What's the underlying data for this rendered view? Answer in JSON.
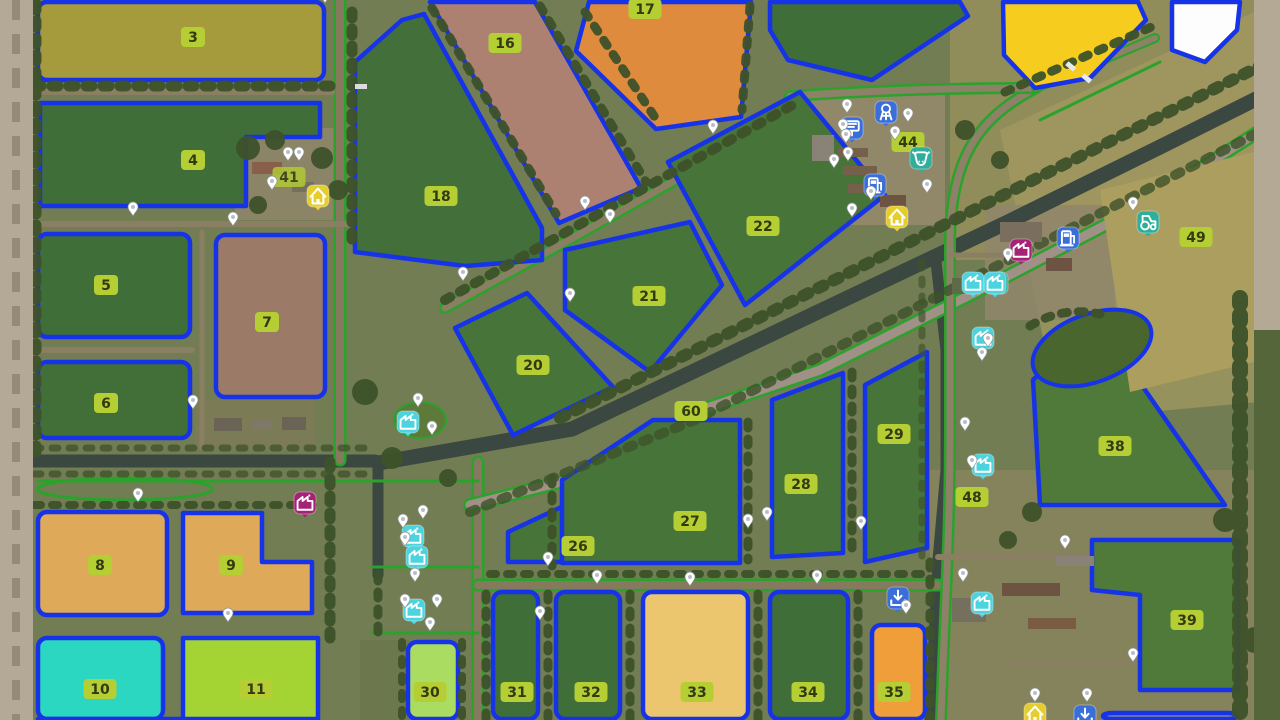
{
  "map": {
    "description": "Top-down farm map overview with numbered fields",
    "field_border_color": "#1733e8",
    "label_bg": "#b5ce33",
    "label_text_color": "#333a12",
    "road_line_color": "#2aa22c",
    "water_color": "#3a4841",
    "fields": [
      {
        "number": "3",
        "color": "#a59a3c",
        "shape": [
          [
            38,
            2
          ],
          [
            324,
            2
          ],
          [
            324,
            80
          ],
          [
            38,
            80
          ]
        ],
        "label": [
          193,
          37
        ]
      },
      {
        "number": "4",
        "color": "#3f6e39",
        "shape": [
          [
            40,
            103
          ],
          [
            320,
            103
          ],
          [
            320,
            137
          ],
          [
            246,
            137
          ],
          [
            246,
            206
          ],
          [
            40,
            206
          ]
        ],
        "label": [
          193,
          160
        ]
      },
      {
        "number": "5",
        "color": "#3f6e39",
        "shape": [
          [
            38,
            234
          ],
          [
            190,
            234
          ],
          [
            190,
            337
          ],
          [
            38,
            337
          ]
        ],
        "label": [
          106,
          285
        ]
      },
      {
        "number": "6",
        "color": "#426f37",
        "shape": [
          [
            38,
            362
          ],
          [
            190,
            362
          ],
          [
            190,
            438
          ],
          [
            38,
            438
          ]
        ],
        "label": [
          106,
          403
        ]
      },
      {
        "number": "7",
        "color": "#9b7a67",
        "shape": [
          [
            216,
            235
          ],
          [
            325,
            235
          ],
          [
            325,
            397
          ],
          [
            216,
            397
          ]
        ],
        "label": [
          267,
          322
        ]
      },
      {
        "number": "8",
        "color": "#dfa95a",
        "shape": [
          [
            38,
            512
          ],
          [
            167,
            512
          ],
          [
            167,
            615
          ],
          [
            38,
            615
          ]
        ],
        "label": [
          100,
          565
        ]
      },
      {
        "number": "9",
        "color": "#dfa95a",
        "shape": [
          [
            183,
            513
          ],
          [
            262,
            513
          ],
          [
            262,
            562
          ],
          [
            312,
            562
          ],
          [
            312,
            613
          ],
          [
            183,
            613
          ]
        ],
        "label": [
          231,
          565
        ]
      },
      {
        "number": "10",
        "color": "#2bd7c0",
        "shape": [
          [
            38,
            638
          ],
          [
            163,
            638
          ],
          [
            163,
            719
          ],
          [
            38,
            719
          ]
        ],
        "label": [
          100,
          689
        ]
      },
      {
        "number": "11",
        "color": "#a4d334",
        "shape": [
          [
            183,
            638
          ],
          [
            318,
            638
          ],
          [
            318,
            719
          ],
          [
            38,
            719
          ],
          [
            183,
            719
          ]
        ],
        "label": [
          256,
          689
        ]
      },
      {
        "number": "16",
        "color": "#ac8172",
        "shape": [
          [
            430,
            2
          ],
          [
            535,
            2
          ],
          [
            641,
            188
          ],
          [
            559,
            223
          ]
        ],
        "label": [
          505,
          43
        ]
      },
      {
        "number": "17",
        "color": "#df8b3e",
        "shape": [
          [
            589,
            2
          ],
          [
            751,
            2
          ],
          [
            741,
            117
          ],
          [
            656,
            129
          ],
          [
            576,
            51
          ]
        ],
        "label": [
          645,
          9
        ]
      },
      {
        "number": "18",
        "color": "#43703a",
        "shape": [
          [
            355,
            62
          ],
          [
            402,
            20
          ],
          [
            424,
            14
          ],
          [
            542,
            228
          ],
          [
            542,
            260
          ],
          [
            465,
            266
          ],
          [
            355,
            252
          ]
        ],
        "label": [
          441,
          196
        ]
      },
      {
        "number": "20",
        "color": "#477539",
        "shape": [
          [
            455,
            328
          ],
          [
            527,
            293
          ],
          [
            613,
            387
          ],
          [
            513,
            435
          ]
        ],
        "label": [
          533,
          365
        ]
      },
      {
        "number": "21",
        "color": "#477539",
        "shape": [
          [
            565,
            250
          ],
          [
            690,
            222
          ],
          [
            722,
            285
          ],
          [
            650,
            372
          ],
          [
            565,
            310
          ]
        ],
        "label": [
          649,
          296
        ]
      },
      {
        "number": "22",
        "color": "#477539",
        "shape": [
          [
            668,
            162
          ],
          [
            800,
            92
          ],
          [
            885,
            195
          ],
          [
            745,
            305
          ]
        ],
        "label": [
          763,
          226
        ]
      },
      {
        "number": "26",
        "color": "#477539",
        "shape": [
          [
            508,
            532
          ],
          [
            570,
            503
          ],
          [
            623,
            496
          ],
          [
            623,
            562
          ],
          [
            508,
            562
          ]
        ],
        "label": [
          578,
          546
        ]
      },
      {
        "number": "27",
        "color": "#477539",
        "shape": [
          [
            653,
            420
          ],
          [
            740,
            420
          ],
          [
            740,
            563
          ],
          [
            562,
            563
          ],
          [
            562,
            480
          ]
        ],
        "label": [
          690,
          521
        ]
      },
      {
        "number": "28",
        "color": "#477539",
        "shape": [
          [
            772,
            400
          ],
          [
            843,
            373
          ],
          [
            843,
            553
          ],
          [
            772,
            557
          ]
        ],
        "label": [
          801,
          484
        ]
      },
      {
        "number": "29",
        "color": "#477539",
        "shape": [
          [
            865,
            385
          ],
          [
            927,
            352
          ],
          [
            927,
            548
          ],
          [
            865,
            562
          ]
        ],
        "label": [
          894,
          434
        ]
      },
      {
        "number": "30",
        "color": "#abdc62",
        "shape": [
          [
            408,
            642
          ],
          [
            458,
            642
          ],
          [
            458,
            719
          ],
          [
            408,
            719
          ]
        ],
        "label": [
          430,
          692
        ]
      },
      {
        "number": "31",
        "color": "#3f6e39",
        "shape": [
          [
            493,
            592
          ],
          [
            538,
            592
          ],
          [
            538,
            719
          ],
          [
            493,
            719
          ]
        ],
        "label": [
          517,
          692
        ]
      },
      {
        "number": "32",
        "color": "#3f6e39",
        "shape": [
          [
            556,
            592
          ],
          [
            620,
            592
          ],
          [
            620,
            719
          ],
          [
            556,
            719
          ]
        ],
        "label": [
          591,
          692
        ]
      },
      {
        "number": "33",
        "color": "#ecc66f",
        "shape": [
          [
            643,
            592
          ],
          [
            748,
            592
          ],
          [
            748,
            719
          ],
          [
            643,
            719
          ]
        ],
        "label": [
          697,
          692
        ]
      },
      {
        "number": "34",
        "color": "#3f6e39",
        "shape": [
          [
            770,
            592
          ],
          [
            848,
            592
          ],
          [
            848,
            719
          ],
          [
            770,
            719
          ]
        ],
        "label": [
          808,
          692
        ]
      },
      {
        "number": "35",
        "color": "#f09e39",
        "shape": [
          [
            872,
            625
          ],
          [
            925,
            625
          ],
          [
            925,
            719
          ],
          [
            872,
            719
          ]
        ],
        "label": [
          894,
          692
        ]
      },
      {
        "number": "38",
        "color": "#4f7a3a",
        "shape": [
          [
            1095,
            318
          ],
          [
            1225,
            505
          ],
          [
            1040,
            505
          ],
          [
            1033,
            380
          ]
        ],
        "label": [
          1115,
          446
        ]
      },
      {
        "number": "39",
        "color": "#4f7a3a",
        "shape": [
          [
            1092,
            540
          ],
          [
            1238,
            540
          ],
          [
            1238,
            690
          ],
          [
            1140,
            690
          ],
          [
            1140,
            595
          ],
          [
            1092,
            590
          ]
        ],
        "label": [
          1187,
          620
        ]
      },
      {
        "number": "49",
        "color": "#ab9e5e",
        "no_border": true,
        "shape": [
          [
            1100,
            190
          ],
          [
            1262,
            150
          ],
          [
            1262,
            360
          ],
          [
            1130,
            392
          ]
        ],
        "label": [
          1196,
          237
        ]
      },
      {
        "number": "41",
        "dim": true,
        "shape": [],
        "label": [
          289,
          177
        ]
      },
      {
        "number": "44",
        "shape": [],
        "label": [
          908,
          142
        ]
      },
      {
        "number": "48",
        "shape": [],
        "label": [
          972,
          497
        ]
      },
      {
        "number": "60",
        "shape": [],
        "label": [
          691,
          411
        ]
      },
      {
        "number": "",
        "color": "#3f6e39",
        "shape": [
          [
            770,
            2
          ],
          [
            960,
            2
          ],
          [
            968,
            16
          ],
          [
            872,
            80
          ],
          [
            788,
            60
          ],
          [
            770,
            30
          ]
        ],
        "label": null
      },
      {
        "number": "",
        "color": "#f6cd1e",
        "shape": [
          [
            1003,
            2
          ],
          [
            1138,
            2
          ],
          [
            1146,
            20
          ],
          [
            1090,
            78
          ],
          [
            1035,
            88
          ],
          [
            1004,
            55
          ]
        ],
        "label": null
      },
      {
        "number": "",
        "color": "#fdfdfd",
        "shape": [
          [
            1172,
            2
          ],
          [
            1240,
            2
          ],
          [
            1237,
            30
          ],
          [
            1205,
            62
          ],
          [
            1172,
            50
          ]
        ],
        "label": null
      },
      {
        "number": "",
        "color": "#7b8795",
        "shape": [
          [
            1103,
            713
          ],
          [
            1237,
            713
          ],
          [
            1237,
            719
          ],
          [
            1103,
            719
          ]
        ],
        "label": null
      }
    ],
    "icons": [
      {
        "name": "farmhouse-icon",
        "glyph": "house",
        "color": "#e5cd2c",
        "x": 318,
        "y": 196
      },
      {
        "name": "farmhouse-icon",
        "glyph": "house",
        "color": "#e5cd2c",
        "x": 897,
        "y": 217
      },
      {
        "name": "info-board-icon",
        "glyph": "board",
        "color": "#3a6fd9",
        "x": 852,
        "y": 128
      },
      {
        "name": "water-tower-icon",
        "glyph": "tower",
        "color": "#3a6fd9",
        "x": 886,
        "y": 112
      },
      {
        "name": "farm-shop-icon",
        "glyph": "fuel",
        "color": "#3a6fd9",
        "x": 875,
        "y": 185
      },
      {
        "name": "cow-pasture-icon",
        "glyph": "cow",
        "color": "#2fae9b",
        "x": 921,
        "y": 158
      },
      {
        "name": "production-point-icon",
        "glyph": "factory",
        "color": "#a62277",
        "x": 1021,
        "y": 250
      },
      {
        "name": "charging-station-icon",
        "glyph": "fuel",
        "color": "#3a6fd9",
        "x": 1068,
        "y": 238
      },
      {
        "name": "vehicle-shop-icon",
        "glyph": "tractor",
        "color": "#2fae9b",
        "x": 1148,
        "y": 222
      },
      {
        "name": "stable-icon",
        "glyph": "house",
        "color": "#2fae9b",
        "x": 997,
        "y": 283
      },
      {
        "name": "production-icon",
        "glyph": "factory",
        "color": "#4cd3de",
        "x": 973,
        "y": 283
      },
      {
        "name": "production-icon",
        "glyph": "factory",
        "color": "#4cd3de",
        "x": 995,
        "y": 283
      },
      {
        "name": "production-icon",
        "glyph": "factory",
        "color": "#4cd3de",
        "x": 983,
        "y": 338
      },
      {
        "name": "production-icon",
        "glyph": "factory",
        "color": "#4cd3de",
        "x": 983,
        "y": 465
      },
      {
        "name": "greenhouse-icon",
        "glyph": "factory",
        "color": "#4cd3de",
        "x": 408,
        "y": 422
      },
      {
        "name": "production-icon",
        "glyph": "factory",
        "color": "#4cd3de",
        "x": 413,
        "y": 536
      },
      {
        "name": "production-icon",
        "glyph": "factory",
        "color": "#4cd3de",
        "x": 417,
        "y": 557
      },
      {
        "name": "production-icon",
        "glyph": "factory",
        "color": "#4cd3de",
        "x": 414,
        "y": 610
      },
      {
        "name": "production-point-icon",
        "glyph": "factory",
        "color": "#a62277",
        "x": 305,
        "y": 503
      },
      {
        "name": "sell-point-icon",
        "glyph": "download",
        "color": "#3a6fd9",
        "x": 898,
        "y": 598
      },
      {
        "name": "production-icon",
        "glyph": "factory",
        "color": "#4cd3de",
        "x": 982,
        "y": 603
      },
      {
        "name": "farmhouse-icon",
        "glyph": "house",
        "color": "#e5cd2c",
        "x": 1035,
        "y": 714
      },
      {
        "name": "sell-point-icon",
        "glyph": "download",
        "color": "#3a6fd9",
        "x": 1085,
        "y": 716
      }
    ],
    "pins": [
      [
        133,
        216
      ],
      [
        233,
        226
      ],
      [
        325,
        3
      ],
      [
        288,
        161
      ],
      [
        299,
        161
      ],
      [
        272,
        190
      ],
      [
        193,
        409
      ],
      [
        138,
        502
      ],
      [
        228,
        622
      ],
      [
        585,
        210
      ],
      [
        610,
        223
      ],
      [
        713,
        134
      ],
      [
        463,
        281
      ],
      [
        570,
        302
      ],
      [
        847,
        113
      ],
      [
        908,
        122
      ],
      [
        895,
        140
      ],
      [
        843,
        133
      ],
      [
        846,
        143
      ],
      [
        848,
        161
      ],
      [
        834,
        168
      ],
      [
        927,
        193
      ],
      [
        871,
        200
      ],
      [
        852,
        217
      ],
      [
        1133,
        211
      ],
      [
        1008,
        262
      ],
      [
        988,
        347
      ],
      [
        982,
        361
      ],
      [
        965,
        431
      ],
      [
        972,
        469
      ],
      [
        748,
        528
      ],
      [
        767,
        521
      ],
      [
        861,
        530
      ],
      [
        690,
        586
      ],
      [
        817,
        584
      ],
      [
        597,
        584
      ],
      [
        540,
        620
      ],
      [
        548,
        566
      ],
      [
        906,
        614
      ],
      [
        963,
        582
      ],
      [
        403,
        528
      ],
      [
        423,
        519
      ],
      [
        405,
        546
      ],
      [
        415,
        582
      ],
      [
        405,
        608
      ],
      [
        437,
        608
      ],
      [
        430,
        631
      ],
      [
        418,
        407
      ],
      [
        432,
        435
      ],
      [
        1065,
        549
      ],
      [
        1133,
        662
      ],
      [
        1035,
        702
      ],
      [
        1087,
        702
      ]
    ]
  }
}
